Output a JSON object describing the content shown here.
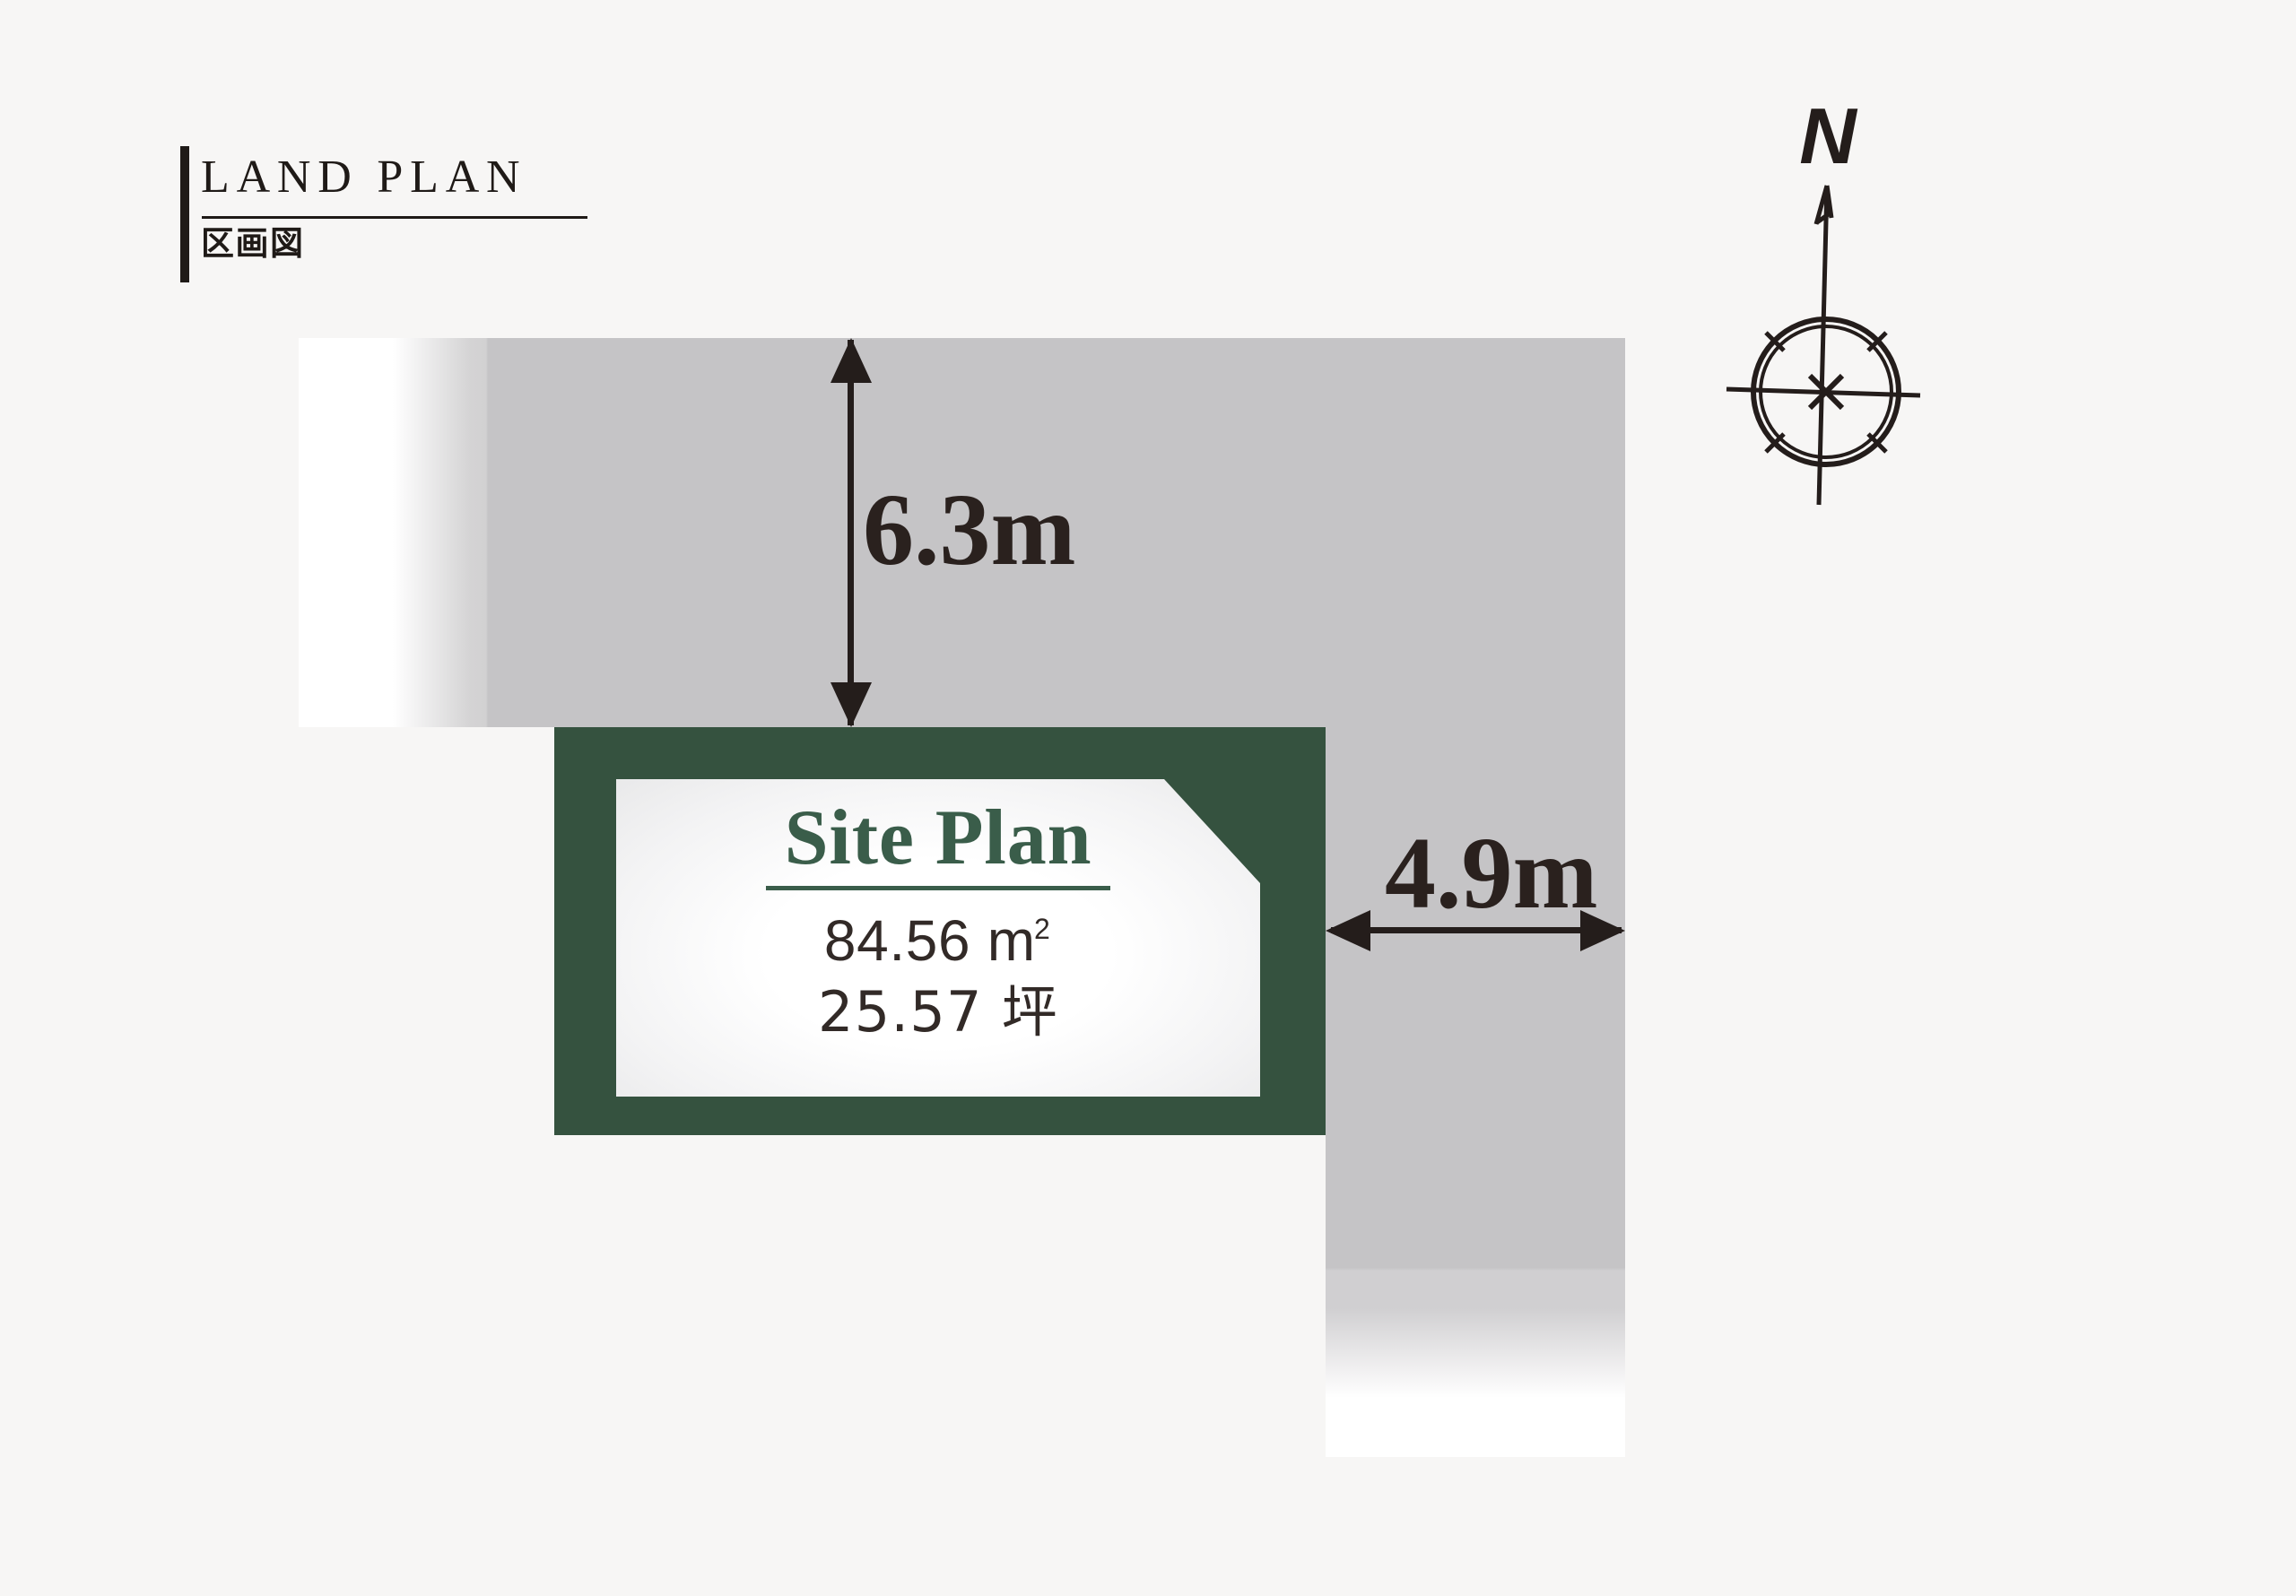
{
  "header": {
    "title": "LAND PLAN",
    "subtitle": "区画図"
  },
  "compass": {
    "label": "N"
  },
  "plot": {
    "title": "Site Plan",
    "area_value": "84.56",
    "area_unit_base": "m",
    "area_unit_sup": "2",
    "area_tsubo": "25.57 坪"
  },
  "dimensions": {
    "top_road_width": "6.3m",
    "side_road_width": "4.9m"
  },
  "colors": {
    "background": "#f7f6f5",
    "road_gray": "#c5c4c6",
    "plot_green": "#35523f",
    "plot_title_green": "#3a5d4a",
    "ink": "#241d1b"
  }
}
